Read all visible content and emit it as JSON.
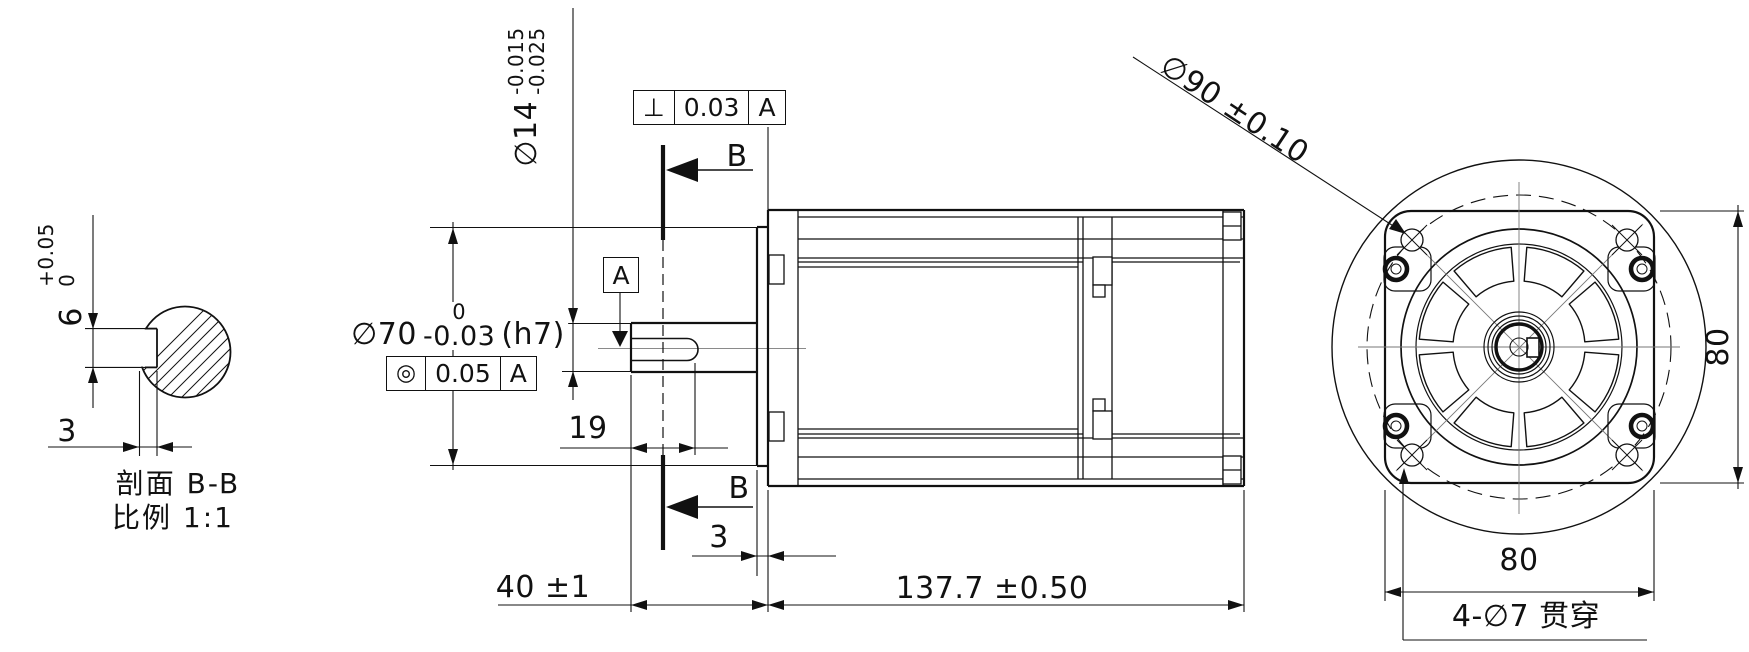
{
  "drawing": {
    "section_view": {
      "title": "剖面 B-B",
      "scale_label": "比例 1:1",
      "keyway_width": {
        "nominal": "6",
        "tol_upper": "+0.05",
        "tol_lower": "0"
      },
      "keyway_depth": "3"
    },
    "side_view": {
      "shaft_dia": {
        "prefix": "∅14",
        "tol_upper": "-0.015",
        "tol_lower": "-0.025"
      },
      "perpendicularity": {
        "symbol": "⊥",
        "value": "0.03",
        "datum": "A"
      },
      "pilot_dia": {
        "prefix": "∅70",
        "tol_upper": "0",
        "tol_lower": "-0.03",
        "fit": "(h7)"
      },
      "concentricity": {
        "symbol": "◎",
        "value": "0.05",
        "datum": "A"
      },
      "datum_label": "A",
      "section_marker_top": "B",
      "section_marker_bottom": "B",
      "keyway_length": "19",
      "pilot_protrusion": "3",
      "shaft_length": "40 ±1",
      "body_length": "137.7 ±0.50"
    },
    "front_view": {
      "bolt_circle": "∅90 ±0.10",
      "flange_width": "80",
      "flange_height": "80",
      "mounting_holes_note": "4-∅7 贯穿"
    },
    "line_color": "#111111"
  }
}
